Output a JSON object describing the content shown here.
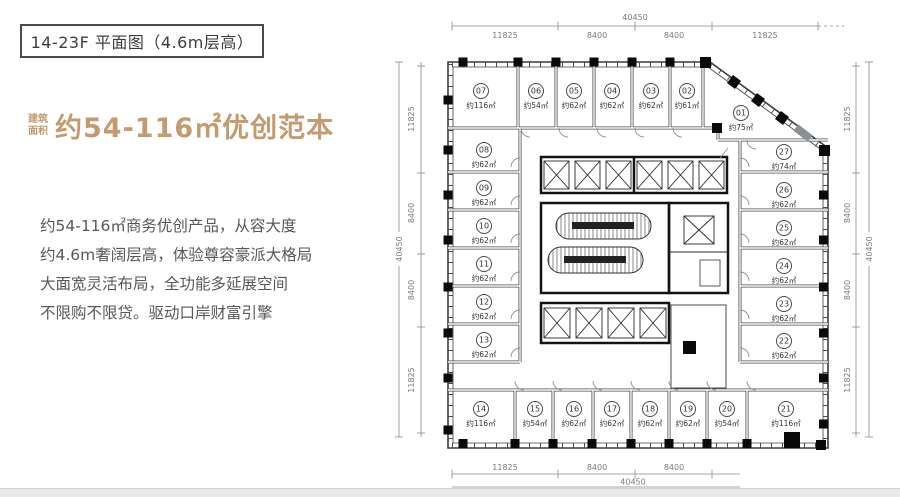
{
  "title_box": {
    "text": "14-23F 平面图（4.6m层高）"
  },
  "headline": {
    "prefix1": "建筑",
    "prefix2": "面积",
    "text": "约54-116㎡优创范本",
    "color": "#c49a6f"
  },
  "description": {
    "lines": [
      "约54-116㎡商务优创产品，从容大度",
      "约4.6m奢阔层高，体验尊容豪派大格局",
      "大面宽灵活布局，全功能多延展空间",
      "不限购不限贷。驱动口岸财富引擎"
    ]
  },
  "plan": {
    "units": [
      {
        "no": "01",
        "area": "约75㎡"
      },
      {
        "no": "02",
        "area": "约61㎡"
      },
      {
        "no": "03",
        "area": "约62㎡"
      },
      {
        "no": "04",
        "area": "约62㎡"
      },
      {
        "no": "05",
        "area": "约62㎡"
      },
      {
        "no": "06",
        "area": "约54㎡"
      },
      {
        "no": "07",
        "area": "约116㎡"
      },
      {
        "no": "08",
        "area": "约62㎡"
      },
      {
        "no": "09",
        "area": "约62㎡"
      },
      {
        "no": "10",
        "area": "约62㎡"
      },
      {
        "no": "11",
        "area": "约62㎡"
      },
      {
        "no": "12",
        "area": "约62㎡"
      },
      {
        "no": "13",
        "area": "约62㎡"
      },
      {
        "no": "14",
        "area": "约116㎡"
      },
      {
        "no": "15",
        "area": "约54㎡"
      },
      {
        "no": "16",
        "area": "约62㎡"
      },
      {
        "no": "17",
        "area": "约62㎡"
      },
      {
        "no": "18",
        "area": "约62㎡"
      },
      {
        "no": "19",
        "area": "约62㎡"
      },
      {
        "no": "20",
        "area": "约54㎡"
      },
      {
        "no": "21",
        "area": "约116㎡"
      },
      {
        "no": "22",
        "area": "约62㎡"
      },
      {
        "no": "23",
        "area": "约62㎡"
      },
      {
        "no": "24",
        "area": "约62㎡"
      },
      {
        "no": "25",
        "area": "约62㎡"
      },
      {
        "no": "26",
        "area": "约62㎡"
      },
      {
        "no": "27",
        "area": "约74㎡"
      }
    ],
    "dims": {
      "top": {
        "total": "40450",
        "segments": [
          "11825",
          "8400",
          "8400",
          "11825"
        ]
      },
      "bottom": {
        "total": "40450",
        "segments": [
          "11825",
          "8400",
          "8400"
        ]
      },
      "left": {
        "total": "40450",
        "segments": [
          "11825",
          "8400",
          "8400",
          "11825"
        ]
      },
      "right": {
        "total": "40450",
        "segments": [
          "11825",
          "8400",
          "8400",
          "11825"
        ]
      }
    }
  }
}
